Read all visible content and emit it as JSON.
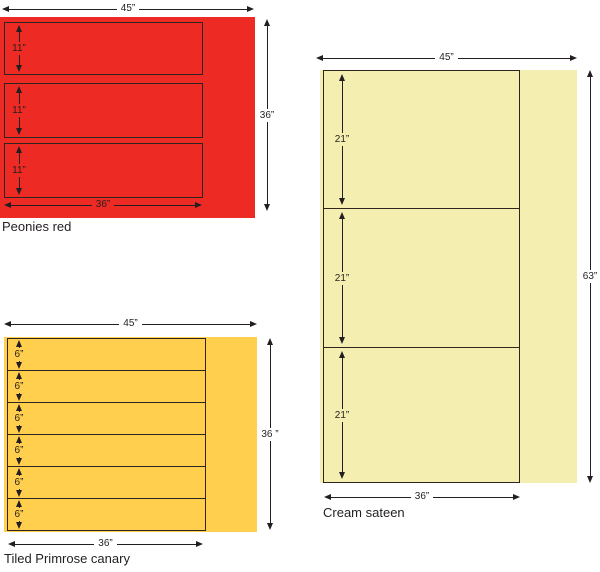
{
  "diagram": {
    "line_color": "#231F20",
    "panels": [
      {
        "caption": "Peonies red",
        "fill": "#EE2A24",
        "fabric_width_label": "45”",
        "fabric_height_label": "36”",
        "cut_width_label": "36”",
        "strips": [
          {
            "label": "11”"
          },
          {
            "label": "11”"
          },
          {
            "label": "11”"
          }
        ]
      },
      {
        "caption": "Tiled Primrose canary",
        "fill": "#FFCF4D",
        "fabric_width_label": "45”",
        "fabric_height_label": "36 ”",
        "cut_width_label": "36”",
        "strips": [
          {
            "label": "6”"
          },
          {
            "label": "6”"
          },
          {
            "label": "6”"
          },
          {
            "label": "6”"
          },
          {
            "label": "6”"
          },
          {
            "label": "6”"
          }
        ]
      },
      {
        "caption": "Cream sateen",
        "fill": "#F4EFB0",
        "fabric_width_label": "45”",
        "fabric_height_label": "63”",
        "cut_width_label": "36”",
        "strips": [
          {
            "label": "21”"
          },
          {
            "label": "21”"
          },
          {
            "label": "21”"
          }
        ]
      }
    ]
  }
}
